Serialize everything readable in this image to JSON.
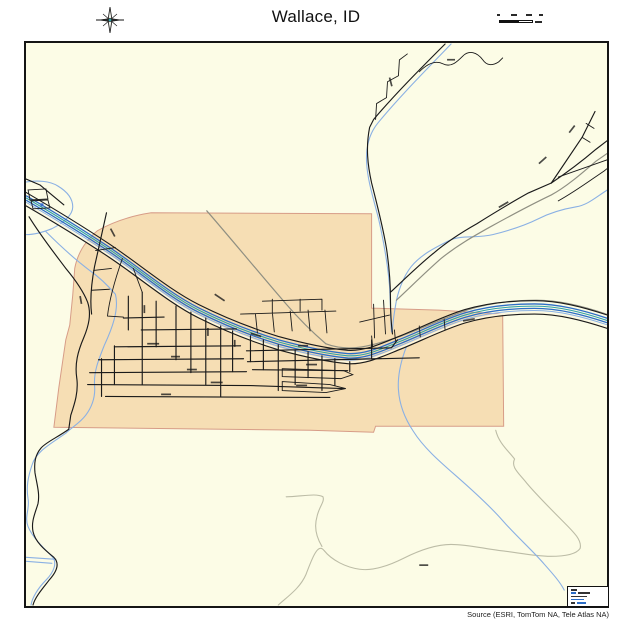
{
  "title": "Wallace, ID",
  "attribution": "Source (ESRI, TomTom NA, Tele Atlas NA)",
  "map": {
    "place_name": "Wallace, ID",
    "features": {
      "city_area": "Wallace city limits (shaded polygon)",
      "river_corridor": "river and highway corridor",
      "street_grid": "downtown street grid",
      "streams": "creeks and tributaries",
      "trail": "unpaved trail loop"
    },
    "colors": {
      "map_bg": "#fcfce6",
      "city_fill": "#f6deb4",
      "city_border": "#d79c87",
      "road": "#1a1a1a",
      "road_secondary": "#8f8f82",
      "river": "#2c6dc6",
      "river_teal": "#2fa0a6",
      "stream": "#8ab0e4",
      "trail": "#bcbca6",
      "highway_median": "#fdf8e0",
      "marker": "#3a6bc9"
    }
  }
}
